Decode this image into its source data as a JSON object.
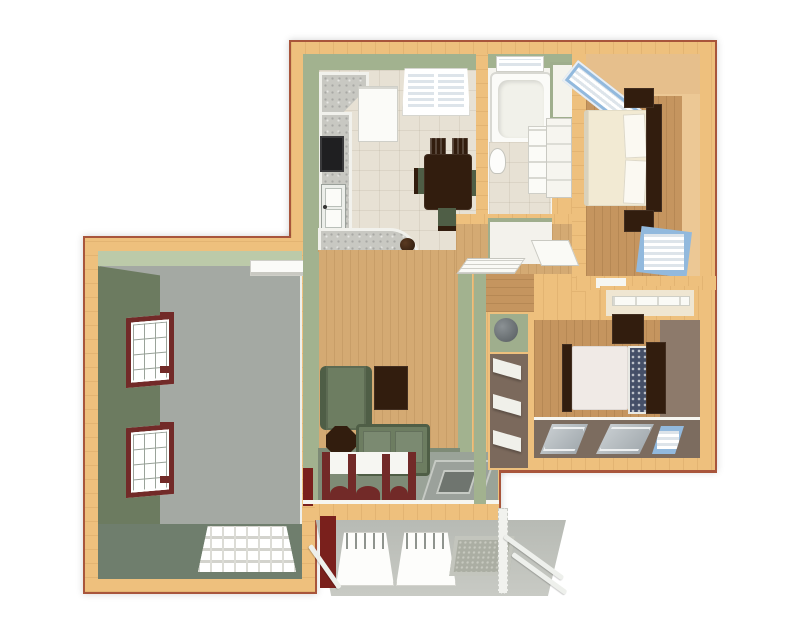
{
  "scene": {
    "title": "3D dollhouse-view apartment floor plan with attached garage",
    "view": "top-down-3d-render",
    "background": "#ffffff"
  },
  "palette": {
    "exterior_wall": "#eec07d",
    "exterior_edge": "#a8553b",
    "wall_sage": "#a2b28f",
    "wall_sage_light": "#bccaa9",
    "wall_sage_dark": "#6c7b60",
    "garage_floor": "#a4a9a3",
    "garage_apron": "#6f7e6d",
    "tile_floor": "#e7e1d4",
    "wood_floor": "#d4aa73",
    "wood_floor_dark": "#c5955f",
    "bedroom1_wall": "#ecc895",
    "bedroom2_wall": "#8d7a6b",
    "bedroom2_floor_band": "#7c6c5f",
    "counter_granite": "#c8c8c2",
    "appliance_black": "#1f1f21",
    "furniture_dark": "#321d0e",
    "sofa_green": "#6d7d61",
    "sofa_green_dark": "#4f5e46",
    "bed_cream": "#f2ead3",
    "bed_white": "#f0eae6",
    "pillow_navy": "#454f68",
    "window_blue": "#92b9dd",
    "window_maroon": "#722a28",
    "porch_concrete": "#b7bab4",
    "door_gray": "#9ba19b",
    "mat_gray": "#abaea3",
    "accent_red_wall": "#7a201c",
    "white_trim": "#f6f6f1"
  },
  "rooms": [
    {
      "id": "garage",
      "label": "garage",
      "floor": "concrete",
      "walls": "sage-green"
    },
    {
      "id": "kitchen-dining",
      "label": "kitchen-dining",
      "floor": "tile",
      "walls": "sage-green"
    },
    {
      "id": "bathroom",
      "label": "bathroom",
      "floor": "tile",
      "walls": "sage-green"
    },
    {
      "id": "hallway-closets",
      "label": "hallway-closets",
      "floor": "wood",
      "walls": "sage-green"
    },
    {
      "id": "living-room",
      "label": "living-room",
      "floor": "wood",
      "walls": "sage-green"
    },
    {
      "id": "bedroom-1",
      "label": "bedroom-top-right",
      "floor": "wood",
      "walls": "peach-tan"
    },
    {
      "id": "bedroom-2",
      "label": "bedroom-bottom-right",
      "floor": "wood",
      "walls": "taupe-brown"
    },
    {
      "id": "porch",
      "label": "entry-porch",
      "floor": "concrete",
      "walls": "open-railing"
    }
  ],
  "furniture": {
    "garage": [
      "garage-door-panel",
      "maroon-window-upper",
      "maroon-window-lower",
      "wall-shelf"
    ],
    "kitchen": [
      "refrigerator",
      "corner-counter",
      "range-cooktop",
      "double-sink",
      "top-wall-window",
      "dining-table",
      "dining-chairs-x4"
    ],
    "bar": [
      "granite-peninsula",
      "bar-stools-x6"
    ],
    "bathroom": [
      "bathtub",
      "toilet",
      "vanity-cabinet",
      "window-over-tub",
      "small-closet",
      "linen-cabinet"
    ],
    "hallway": [
      "louvered-door",
      "water-heater",
      "louvered-utility-closet",
      "open-door-leaf"
    ],
    "living_room": [
      "sofa",
      "loveseat",
      "octagon-side-table",
      "media-cabinet",
      "triple-maroon-window",
      "entry-door",
      "entry-pad",
      "red-accent-wall"
    ],
    "bedroom_1": [
      "bed-cream",
      "pillows-x2",
      "headboard",
      "nightstand-top",
      "nightstand-bottom",
      "corner-window-blue",
      "lower-window-blue",
      "door-frame"
    ],
    "bedroom_2": [
      "bed-white",
      "patterned-pillows",
      "headboard",
      "footboard",
      "dresser",
      "window-panel-a",
      "window-panel-b",
      "window-panel-blue"
    ],
    "closet_between_bedrooms": [
      "closet-rod-shelf"
    ],
    "porch": [
      "railing-panel-left",
      "railing-panel-center",
      "doormat",
      "corner-post",
      "diagonal-rails",
      "maroon-wall-segment"
    ]
  },
  "counts": {
    "bar_stools": 6,
    "garage_windows": 2,
    "living_room_window_posts": 4,
    "bedrooms": 2
  }
}
